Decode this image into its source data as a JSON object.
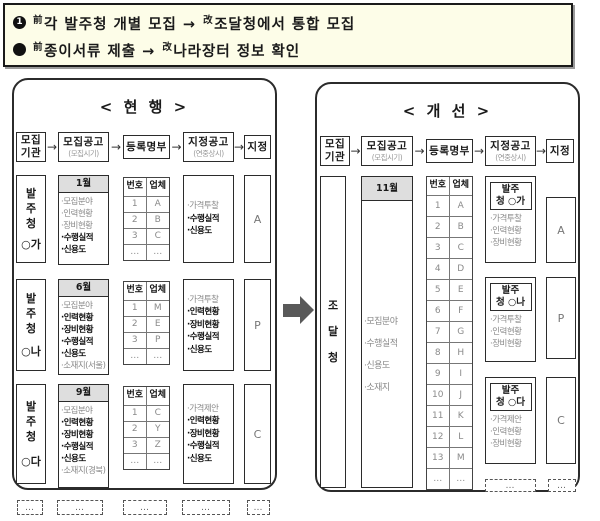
{
  "colors": {
    "note_background": "#FDFDE8",
    "month_header_background": "#DEDEDE",
    "big_arrow": "#595959",
    "dim_text": "#8a8a8a"
  },
  "note": {
    "bullets": [
      {
        "marker": "1",
        "sup1": "前",
        "text1": "각 발주청 개별 모집 →",
        "sup2": "改",
        "text2": "조달청에서 통합 모집"
      },
      {
        "marker": "",
        "sup1": "前",
        "text1": "종이서류 제출 →",
        "sup2": "改",
        "text2": "나라장터 정보 확인"
      }
    ]
  },
  "flow": {
    "arrow": "→",
    "steps": [
      {
        "l1": "모집",
        "sub2": "기관"
      },
      {
        "l1": "모집공고",
        "sub": "(모집시기)"
      },
      {
        "l1": "등록명부"
      },
      {
        "l1": "지정공고",
        "sub": "(연중상시)"
      },
      {
        "l1": "지정"
      }
    ]
  },
  "register_header": {
    "no": "번호",
    "firm": "업체"
  },
  "current": {
    "title": "< 현 행 >",
    "rows": [
      {
        "agency_chars": "발주청",
        "agency_name": "○가",
        "month": "1월",
        "notice_items": [
          "·모집분야",
          "·인력현황",
          "·장비현황",
          "·수행실적",
          "·신용도"
        ],
        "reg_rows": [
          [
            "1",
            "A"
          ],
          [
            "2",
            "B"
          ],
          [
            "3",
            "C"
          ],
          [
            "…",
            "…"
          ]
        ],
        "desig_items": [
          "·가격투찰",
          "·수행실적",
          "·신용도"
        ],
        "result": "A"
      },
      {
        "agency_chars": "발주청",
        "agency_name": "○나",
        "month": "6월",
        "notice_items": [
          "·모집분야",
          "·인력현황",
          "·장비현황",
          "·수행실적",
          "·신용도",
          "·소재지(서울)"
        ],
        "reg_rows": [
          [
            "1",
            "M"
          ],
          [
            "2",
            "E"
          ],
          [
            "3",
            "P"
          ],
          [
            "…",
            "…"
          ]
        ],
        "desig_items": [
          "·가격투찰",
          "·인력현황",
          "·장비현황",
          "·수행실적",
          "·신용도"
        ],
        "result": "P"
      },
      {
        "agency_chars": "발주청",
        "agency_name": "○다",
        "month": "9월",
        "notice_items": [
          "·모집분야",
          "·인력현황",
          "·장비현황",
          "·수행실적",
          "·신용도",
          "·소재지(경북)"
        ],
        "reg_rows": [
          [
            "1",
            "C"
          ],
          [
            "2",
            "Y"
          ],
          [
            "3",
            "Z"
          ],
          [
            "…",
            "…"
          ]
        ],
        "desig_items": [
          "·가격제안",
          "·인력현황",
          "·장비현황",
          "·수행실적",
          "·신용도"
        ],
        "result": "C"
      }
    ],
    "ellipsis": [
      "…",
      "…",
      "…",
      "…",
      "…"
    ]
  },
  "improved": {
    "title": "< 개 선 >",
    "agency_chars": "조달청",
    "month": "11월",
    "notice_items": [
      "·모집분야",
      "·수행실적",
      "·신용도",
      "·소재지"
    ],
    "reg_rows": [
      [
        "1",
        "A"
      ],
      [
        "2",
        "B"
      ],
      [
        "3",
        "C"
      ],
      [
        "4",
        "D"
      ],
      [
        "5",
        "E"
      ],
      [
        "6",
        "F"
      ],
      [
        "7",
        "G"
      ],
      [
        "8",
        "H"
      ],
      [
        "9",
        "I"
      ],
      [
        "10",
        "J"
      ],
      [
        "11",
        "K"
      ],
      [
        "12",
        "L"
      ],
      [
        "13",
        "M"
      ],
      [
        "…",
        "…"
      ]
    ],
    "designations": [
      {
        "label1": "발주",
        "label2": "청 ○가",
        "items": [
          "·가격투찰",
          "·인력현황",
          "·장비현황"
        ],
        "result": "A"
      },
      {
        "label1": "발주",
        "label2": "청 ○나",
        "items": [
          "·가격투찰",
          "·인력현황",
          "·장비현황"
        ],
        "result": "P"
      },
      {
        "label1": "발주",
        "label2": "청 ○다",
        "items": [
          "·가격제안",
          "·인력현황",
          "·장비현황"
        ],
        "result": "C"
      }
    ],
    "ellipsis": [
      "…",
      "…"
    ]
  }
}
